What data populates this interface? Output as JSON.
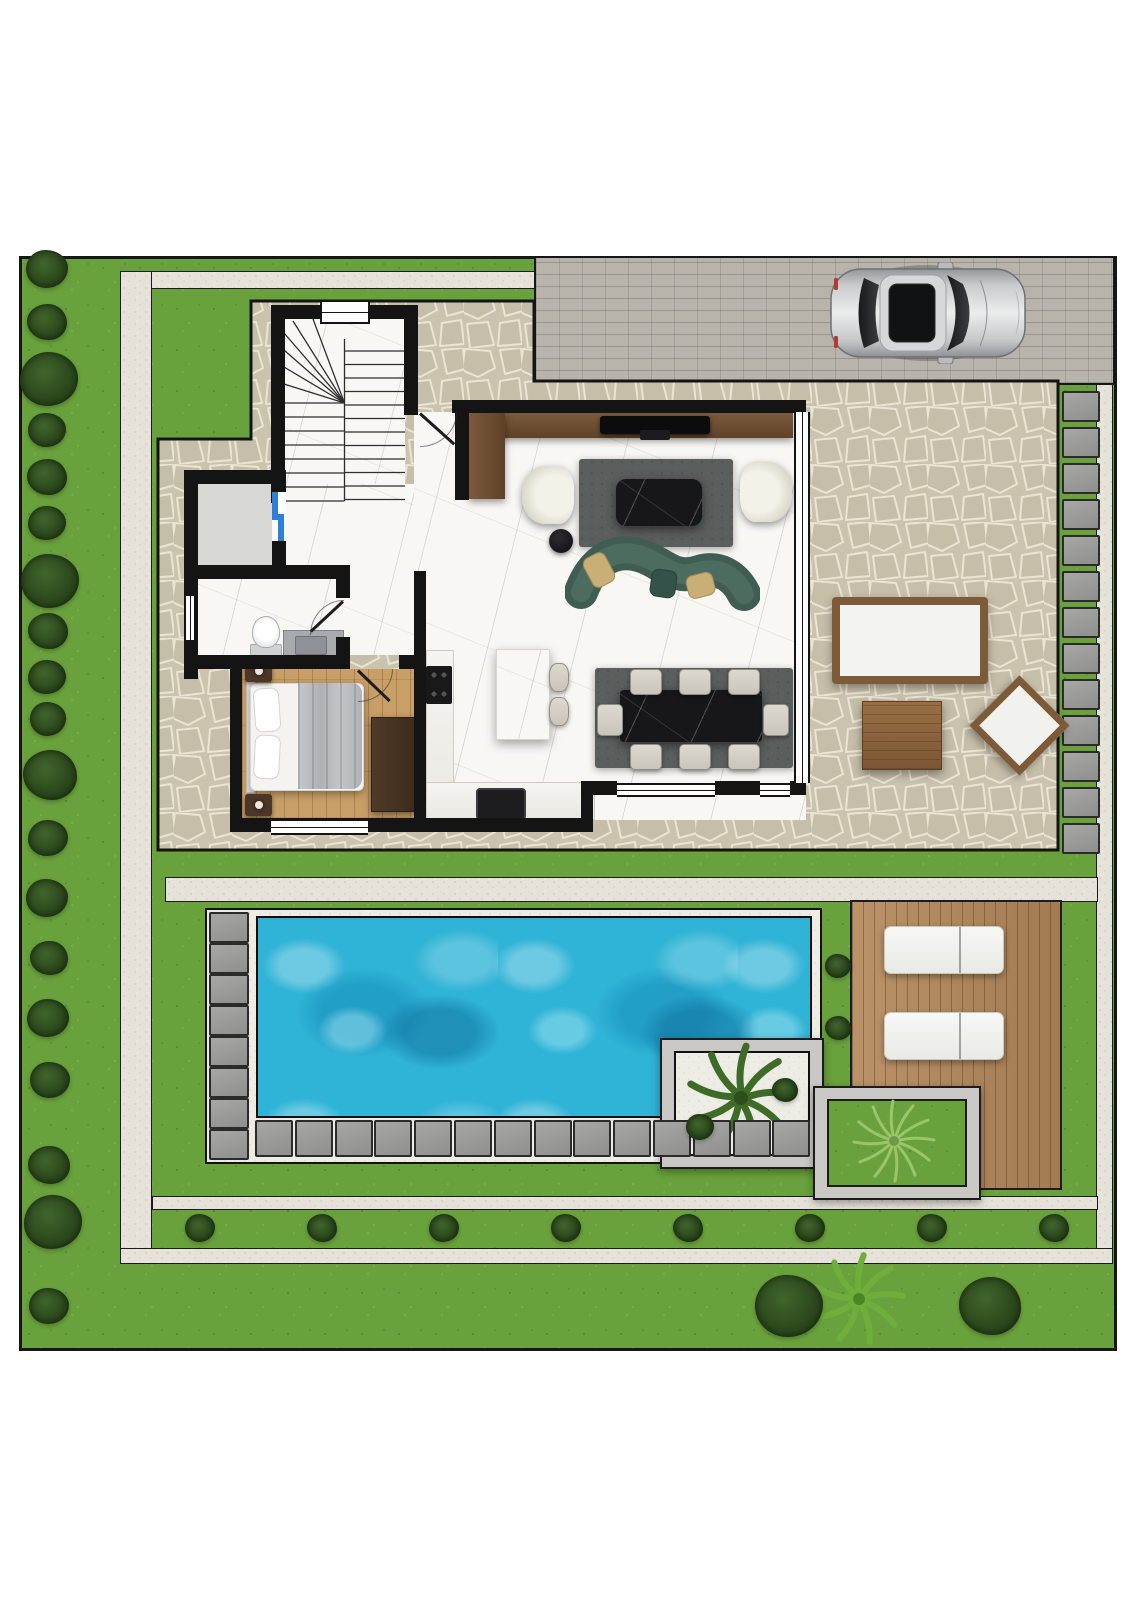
{
  "meta": {
    "description": "Top-down architectural site plan rendering of a villa ground floor with garden, driveway, terrace and swimming pool",
    "canvas": {
      "width": 1131,
      "height": 1600
    },
    "visible_text": []
  },
  "colors": {
    "grass": "#69a23c",
    "bush": "#2c4a1d",
    "gravel": "#e6e2d9",
    "patio_stone": "#cac4af",
    "driveway": "#b8b4ac",
    "wall": "#141414",
    "marble": "#f8f7f4",
    "wood_floor": "#c89f67",
    "deck": "#b5895c",
    "water": "#2fb3d6",
    "rug": "#5a5e5d",
    "sofa": "#3f5d52",
    "pillow": "#c9ae76",
    "furniture_wood": "#7d5a38",
    "cream_seat": "#efece4",
    "paver": "#9b9b99",
    "planter": "#c9c8c4",
    "elevator_door": "#2f7fd6",
    "car_body": "#c8cacc"
  },
  "inventory": {
    "rooms": [
      {
        "name": "staircase",
        "features": [
          "two flights",
          "winder steps",
          "window"
        ]
      },
      {
        "name": "storage-elevator",
        "features": [
          "grey floor",
          "blue sliding door"
        ]
      },
      {
        "name": "bathroom",
        "fixtures": [
          "toilet",
          "vanity with sink",
          "window",
          "door"
        ]
      },
      {
        "name": "bedroom",
        "furniture": [
          "double bed",
          "2 nightstands with lamps",
          "wardrobe",
          "window",
          "door"
        ]
      },
      {
        "name": "kitchen",
        "fixtures": [
          "cooktop",
          "sink",
          "island",
          "2 bar stools",
          "L counter"
        ]
      },
      {
        "name": "living-room",
        "furniture": [
          "tv console",
          "tv",
          "2 armchairs",
          "rug",
          "marble coffee table",
          "round side table",
          "curved green sofa",
          "3 cushions"
        ]
      },
      {
        "name": "dining-area",
        "furniture": [
          "rug",
          "black marble table",
          "8 chairs"
        ]
      }
    ],
    "outdoor": [
      {
        "name": "driveway",
        "features": [
          "paved bricks",
          "silver car parked facing right"
        ]
      },
      {
        "name": "stone-terrace",
        "furniture": [
          "wood bench with white cushion",
          "square wood coffee table",
          "diamond-set wood chair"
        ]
      },
      {
        "name": "swimming-pool",
        "features": [
          "white gravel surround",
          "8 pavers left column",
          "14 pavers bottom row"
        ]
      },
      {
        "name": "pool-deck",
        "furniture": [
          "2 white sun loungers"
        ]
      },
      {
        "name": "planter-palm",
        "features": [
          "palm tree",
          "2 bushes",
          "white gravel"
        ]
      },
      {
        "name": "planter-grass",
        "features": [
          "feather plant",
          "lawn fill"
        ]
      },
      {
        "name": "garden",
        "features": [
          "bush rows",
          "stepping stones",
          "gravel paths",
          "2 large bushes and palm at bottom"
        ]
      }
    ]
  },
  "generated": {
    "left_bushes": [
      {
        "x": 47,
        "y": 269,
        "r": 21
      },
      {
        "x": 47,
        "y": 322,
        "r": 20
      },
      {
        "x": 49,
        "y": 379,
        "r": 29
      },
      {
        "x": 47,
        "y": 430,
        "r": 19
      },
      {
        "x": 47,
        "y": 477,
        "r": 20
      },
      {
        "x": 47,
        "y": 523,
        "r": 19
      },
      {
        "x": 50,
        "y": 581,
        "r": 29
      },
      {
        "x": 48,
        "y": 631,
        "r": 20
      },
      {
        "x": 47,
        "y": 677,
        "r": 19
      },
      {
        "x": 48,
        "y": 719,
        "r": 18
      },
      {
        "x": 50,
        "y": 775,
        "r": 27
      },
      {
        "x": 48,
        "y": 838,
        "r": 20
      },
      {
        "x": 47,
        "y": 898,
        "r": 21
      },
      {
        "x": 49,
        "y": 958,
        "r": 19
      },
      {
        "x": 48,
        "y": 1018,
        "r": 21
      },
      {
        "x": 50,
        "y": 1080,
        "r": 20
      },
      {
        "x": 49,
        "y": 1165,
        "r": 21
      },
      {
        "x": 53,
        "y": 1222,
        "r": 29
      },
      {
        "x": 49,
        "y": 1306,
        "r": 20
      }
    ],
    "bottom_row_bushes": {
      "x0": 200,
      "step": 122,
      "count": 8,
      "y": 1228,
      "r": 15
    },
    "pool_side_bushes": [
      {
        "x": 838,
        "y": 966,
        "r": 13
      },
      {
        "x": 838,
        "y": 1028,
        "r": 13
      }
    ],
    "planter_bushes": [
      {
        "x": 700,
        "y": 1127,
        "r": 14
      },
      {
        "x": 785,
        "y": 1090,
        "r": 13
      }
    ],
    "big_bottom_bushes": [
      {
        "x": 789,
        "y": 1306,
        "r": 34
      },
      {
        "x": 990,
        "y": 1306,
        "r": 31
      }
    ],
    "stepping_stones": {
      "right_column": {
        "x": 1062,
        "y0": 391,
        "step": 36,
        "count": 13,
        "w": 34,
        "h": 27
      },
      "pool_left_column": {
        "x": 209,
        "y0": 912,
        "step": 31,
        "count": 8,
        "w": 36,
        "h": 27
      },
      "pool_bottom_row": {
        "x0": 255,
        "y": 1120,
        "step": 39.8,
        "count": 14,
        "w": 34,
        "h": 33
      }
    },
    "dining_chairs": [
      {
        "x": 630,
        "y": 669,
        "w": 30,
        "h": 24
      },
      {
        "x": 679,
        "y": 669,
        "w": 30,
        "h": 24
      },
      {
        "x": 728,
        "y": 669,
        "w": 30,
        "h": 24
      },
      {
        "x": 630,
        "y": 744,
        "w": 30,
        "h": 24
      },
      {
        "x": 679,
        "y": 744,
        "w": 30,
        "h": 24
      },
      {
        "x": 728,
        "y": 744,
        "w": 30,
        "h": 24
      },
      {
        "x": 597,
        "y": 704,
        "w": 24,
        "h": 30
      },
      {
        "x": 763,
        "y": 704,
        "w": 24,
        "h": 30
      }
    ],
    "bar_stools": [
      {
        "x": 549,
        "y": 663,
        "w": 18,
        "h": 27
      },
      {
        "x": 549,
        "y": 697,
        "w": 18,
        "h": 27
      }
    ],
    "sun_loungers": [
      {
        "x": 884,
        "y": 926
      },
      {
        "x": 884,
        "y": 1012
      }
    ]
  }
}
